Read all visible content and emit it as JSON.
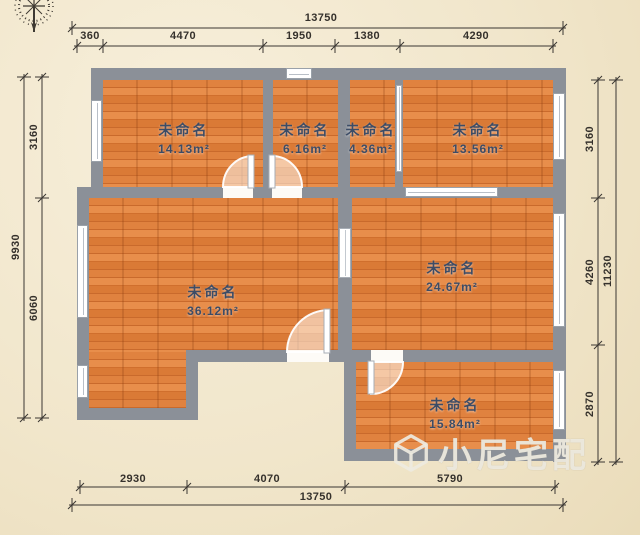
{
  "plan": {
    "rooms": [
      {
        "name": "未命名",
        "area": "14.13m²"
      },
      {
        "name": "未命名",
        "area": "6.16m²"
      },
      {
        "name": "未命名",
        "area": "4.36m²"
      },
      {
        "name": "未命名",
        "area": "13.56m²"
      },
      {
        "name": "未命名",
        "area": "36.12m²"
      },
      {
        "name": "未命名",
        "area": "24.67m²"
      },
      {
        "name": "未命名",
        "area": "15.84m²"
      }
    ],
    "dimensions": {
      "top": {
        "overall": "13750",
        "segments": [
          "360",
          "4470",
          "1950",
          "1380",
          "4290"
        ]
      },
      "left": {
        "overall": "9930",
        "segments": [
          "3160",
          "6060"
        ]
      },
      "right": {
        "overall": "11230",
        "segments": [
          "3160",
          "4260",
          "2870"
        ]
      },
      "bottom": {
        "overall": "13750",
        "segments": [
          "2930",
          "4070",
          "5790"
        ]
      }
    },
    "icons": {
      "compass": "compass-rose-icon",
      "logo": "cube-logo-icon"
    },
    "watermark": {
      "brand": "小尼宅配"
    },
    "colors": {
      "background": "#f2e8d0",
      "wall": "#8b9098",
      "floor": "#dc7e3e",
      "room_label": "#3c4c66",
      "dimension_text": "#35312c"
    }
  }
}
